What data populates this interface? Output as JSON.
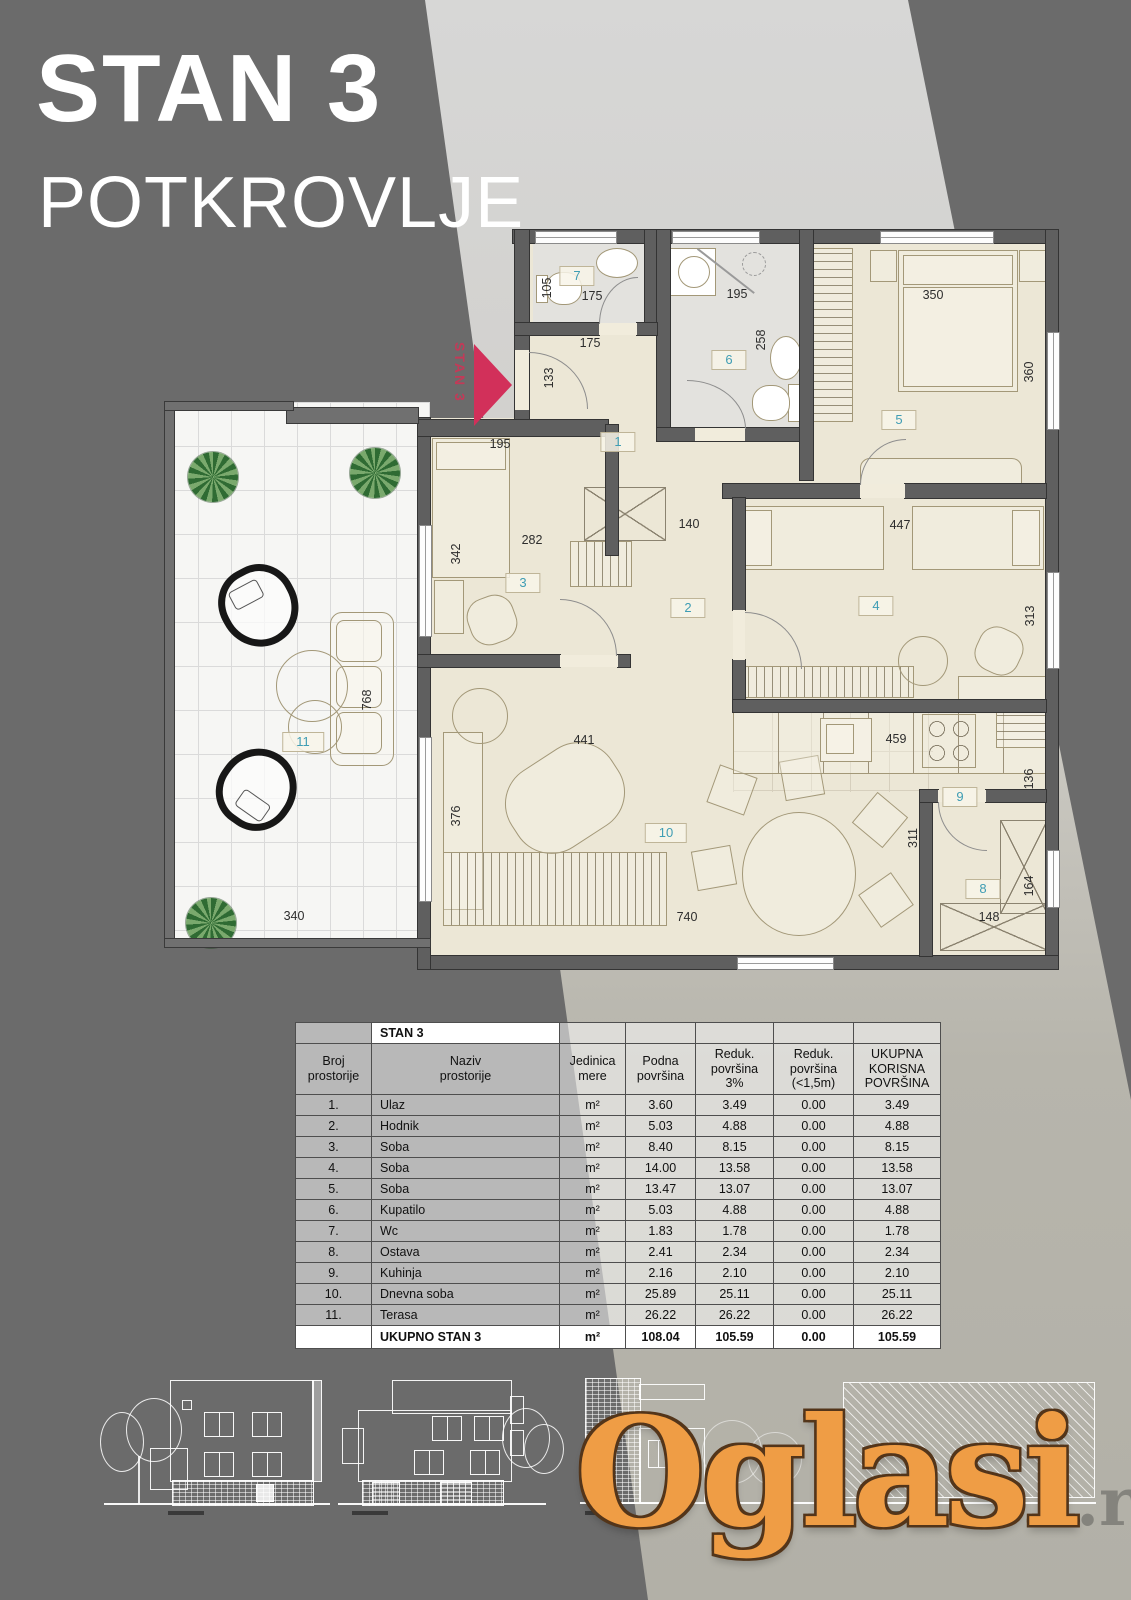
{
  "title": {
    "line1": "STAN 3",
    "line2": "POTKROVLJE"
  },
  "plan": {
    "marker_label": "STAN 3",
    "rooms": [
      {
        "n": "1"
      },
      {
        "n": "2"
      },
      {
        "n": "3"
      },
      {
        "n": "4"
      },
      {
        "n": "5"
      },
      {
        "n": "6"
      },
      {
        "n": "7"
      },
      {
        "n": "8"
      },
      {
        "n": "9"
      },
      {
        "n": "10"
      },
      {
        "n": "11"
      }
    ],
    "dims": [
      {
        "v": "105"
      },
      {
        "v": "175"
      },
      {
        "v": "175"
      },
      {
        "v": "133"
      },
      {
        "v": "195"
      },
      {
        "v": "258"
      },
      {
        "v": "350"
      },
      {
        "v": "360"
      },
      {
        "v": "195"
      },
      {
        "v": "282"
      },
      {
        "v": "342"
      },
      {
        "v": "140"
      },
      {
        "v": "447"
      },
      {
        "v": "313"
      },
      {
        "v": "441"
      },
      {
        "v": "376"
      },
      {
        "v": "740"
      },
      {
        "v": "459"
      },
      {
        "v": "136"
      },
      {
        "v": "311"
      },
      {
        "v": "164"
      },
      {
        "v": "148"
      },
      {
        "v": "340"
      },
      {
        "v": "768"
      }
    ]
  },
  "table": {
    "title": "STAN 3",
    "headers": [
      "Broj\nprostorije",
      "Naziv\nprostorije",
      "Jedinica\nmere",
      "Podna\npovršina",
      "Reduk.\npovršina\n3%",
      "Reduk.\npovršina\n(<1,5m)",
      "UKUPNA\nKORISNA\nPOVRŠINA"
    ],
    "rows": [
      {
        "no": "1.",
        "name": "Ulaz",
        "unit": "m²",
        "floor": "3.60",
        "red3": "3.49",
        "red15": "0.00",
        "total": "3.49"
      },
      {
        "no": "2.",
        "name": "Hodnik",
        "unit": "m²",
        "floor": "5.03",
        "red3": "4.88",
        "red15": "0.00",
        "total": "4.88"
      },
      {
        "no": "3.",
        "name": "Soba",
        "unit": "m²",
        "floor": "8.40",
        "red3": "8.15",
        "red15": "0.00",
        "total": "8.15"
      },
      {
        "no": "4.",
        "name": "Soba",
        "unit": "m²",
        "floor": "14.00",
        "red3": "13.58",
        "red15": "0.00",
        "total": "13.58"
      },
      {
        "no": "5.",
        "name": "Soba",
        "unit": "m²",
        "floor": "13.47",
        "red3": "13.07",
        "red15": "0.00",
        "total": "13.07"
      },
      {
        "no": "6.",
        "name": "Kupatilo",
        "unit": "m²",
        "floor": "5.03",
        "red3": "4.88",
        "red15": "0.00",
        "total": "4.88"
      },
      {
        "no": "7.",
        "name": "Wc",
        "unit": "m²",
        "floor": "1.83",
        "red3": "1.78",
        "red15": "0.00",
        "total": "1.78"
      },
      {
        "no": "8.",
        "name": "Ostava",
        "unit": "m²",
        "floor": "2.41",
        "red3": "2.34",
        "red15": "0.00",
        "total": "2.34"
      },
      {
        "no": "9.",
        "name": "Kuhinja",
        "unit": "m²",
        "floor": "2.16",
        "red3": "2.10",
        "red15": "0.00",
        "total": "2.10"
      },
      {
        "no": "10.",
        "name": "Dnevna soba",
        "unit": "m²",
        "floor": "25.89",
        "red3": "25.11",
        "red15": "0.00",
        "total": "25.11"
      },
      {
        "no": "11.",
        "name": "Terasa",
        "unit": "m²",
        "floor": "26.22",
        "red3": "26.22",
        "red15": "0.00",
        "total": "26.22"
      }
    ],
    "total": {
      "label": "UKUPNO STAN 3",
      "unit": "m²",
      "floor": "108.04",
      "red3": "105.59",
      "red15": "0.00",
      "total": "105.59"
    }
  },
  "logo": {
    "name": "Oglasi",
    "tld": ".rs"
  },
  "colors": {
    "background_dark": "#6b6b6b",
    "background_light": "#d2d1ce",
    "background_warm": "#b2b0a7",
    "floor_cream": "#ece7d6",
    "wall_gray": "#5f5f5f",
    "room_number_teal": "#3f9db4",
    "accent_red": "#d2305a",
    "logo_orange": "#ef9d45",
    "title_white": "#ffffff"
  }
}
